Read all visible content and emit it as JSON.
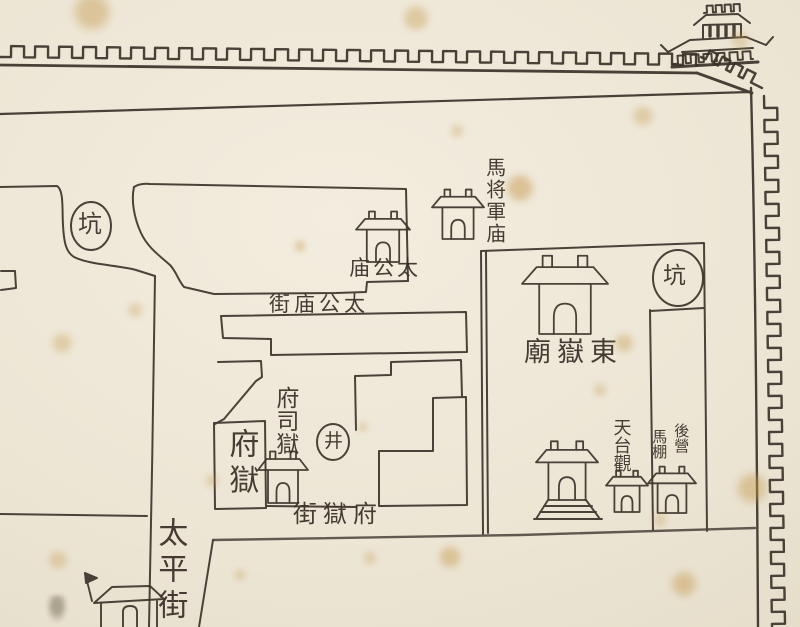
{
  "colors": {
    "paper": "#ece5d5",
    "ink": "#3b332a",
    "stain": "#c59a4f"
  },
  "labels": {
    "pit_west": {
      "text": "坑"
    },
    "pit_east": {
      "text": "坑"
    },
    "taigong_temple": {
      "text": "庙公太",
      "reading": "太公庙",
      "direction": "right-to-left"
    },
    "taigong_temple_street": {
      "text": "街庙公太",
      "reading": "太公庙街",
      "direction": "right-to-left"
    },
    "general_temple": {
      "text": "馬将軍庙",
      "direction": "vertical"
    },
    "dongyue_temple": {
      "text": "廟嶽東",
      "reading": "東嶽廟",
      "direction": "right-to-left"
    },
    "prefecture_jail_office": {
      "text": "府司獄",
      "direction": "vertical"
    },
    "prefecture_jail": {
      "text": "府獄",
      "direction": "vertical"
    },
    "well": {
      "text": "井"
    },
    "prefecture_jail_street": {
      "text": "街獄府",
      "reading": "府獄街",
      "direction": "right-to-left"
    },
    "taiping_street": {
      "text": "太平街",
      "direction": "vertical"
    },
    "tiantai_monastery": {
      "text": "天台觀",
      "direction": "vertical"
    },
    "rear_camp": {
      "text": "後營",
      "direction": "vertical"
    },
    "horse_shed": {
      "text": "馬棚",
      "direction": "vertical"
    }
  },
  "icons": {
    "city_wall": "crenellated-city-wall",
    "corner_tower": "corner-gate-tower-icon",
    "temples": [
      "taigong-temple-icon",
      "general-temple-icon",
      "dongyue-temple-icon",
      "terrace-temple-icon",
      "tiantai-building-icon",
      "horse-shed-building-icon",
      "jail-house-icon",
      "bottom-house-icon"
    ],
    "pit_circles": [
      "pit-oval-west",
      "pit-oval-east"
    ],
    "well_circle": "well-circle"
  }
}
